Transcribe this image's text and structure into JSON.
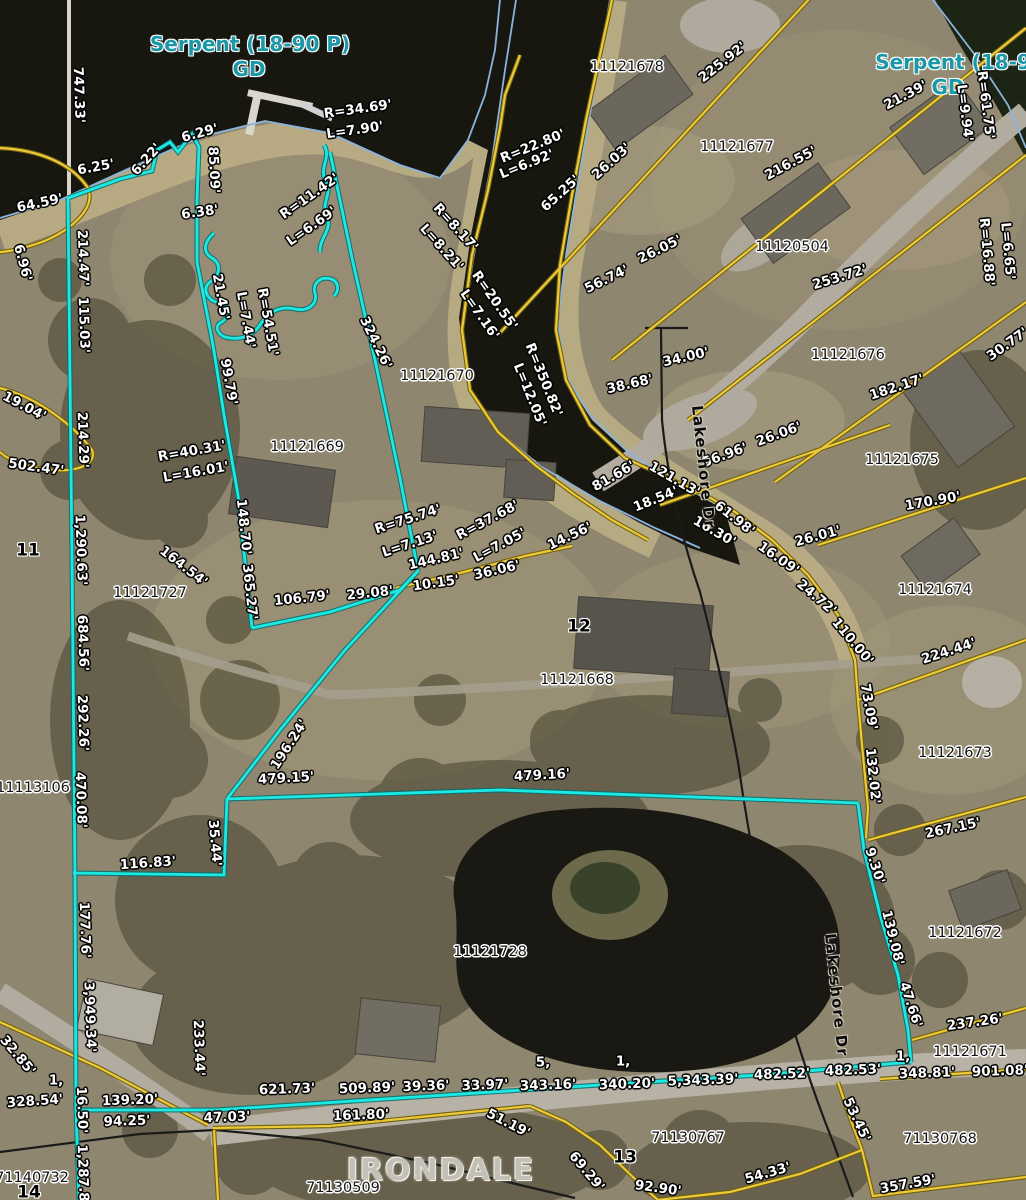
{
  "map": {
    "place_name": "IRONDALE",
    "street_name": "Lakeshore Dr",
    "water_feature": "Serpent (18-90 P) GD"
  },
  "colors": {
    "highlight_boundary": "#1de9e3",
    "parcel_line": "#eec939",
    "shoreline": "#8ab4dd",
    "survey_line": "#1a1a1a",
    "dimension_text": "#ffffff",
    "parcel_id_text": "#141414",
    "water_label_text": "#1b98a8"
  },
  "labels": [
    {
      "t": "Serpent (18-90 P)",
      "x": 250,
      "y": 44,
      "r": 0,
      "c": "water"
    },
    {
      "t": "GD",
      "x": 249,
      "y": 69,
      "r": 0,
      "c": "water"
    },
    {
      "t": "Serpent (18-90",
      "x": 960,
      "y": 62,
      "r": 0,
      "c": "water"
    },
    {
      "t": "GD",
      "x": 948,
      "y": 87,
      "r": 0,
      "c": "water"
    },
    {
      "t": "747.33'",
      "x": 78,
      "y": 95,
      "r": 88,
      "c": "dim"
    },
    {
      "t": "6.29'",
      "x": 200,
      "y": 134,
      "r": -15,
      "c": "dim"
    },
    {
      "t": "6.25'",
      "x": 96,
      "y": 168,
      "r": -10,
      "c": "dim"
    },
    {
      "t": "6.22'",
      "x": 147,
      "y": 160,
      "r": -48,
      "c": "dim"
    },
    {
      "t": "64.59'",
      "x": 40,
      "y": 204,
      "r": -12,
      "c": "dim"
    },
    {
      "t": "85.09'",
      "x": 213,
      "y": 170,
      "r": 87,
      "c": "dim"
    },
    {
      "t": "6.38'",
      "x": 200,
      "y": 213,
      "r": -8,
      "c": "dim"
    },
    {
      "t": "6.96'",
      "x": 22,
      "y": 263,
      "r": 75,
      "c": "dim"
    },
    {
      "t": "R=11.42'",
      "x": 310,
      "y": 197,
      "r": -35,
      "c": "dim"
    },
    {
      "t": "L=6.69'",
      "x": 312,
      "y": 227,
      "r": -35,
      "c": "dim"
    },
    {
      "t": "R=34.69'",
      "x": 358,
      "y": 110,
      "r": -8,
      "c": "dim"
    },
    {
      "t": "L=7.90'",
      "x": 355,
      "y": 131,
      "r": -8,
      "c": "dim"
    },
    {
      "t": "R=22.80'",
      "x": 533,
      "y": 147,
      "r": -22,
      "c": "dim"
    },
    {
      "t": "L=6.92'",
      "x": 527,
      "y": 165,
      "r": -22,
      "c": "dim"
    },
    {
      "t": "225.92'",
      "x": 723,
      "y": 63,
      "r": -38,
      "c": "dim"
    },
    {
      "t": "21.39'",
      "x": 906,
      "y": 96,
      "r": -28,
      "c": "dim"
    },
    {
      "t": "65.25'",
      "x": 561,
      "y": 194,
      "r": -42,
      "c": "dim"
    },
    {
      "t": "26.03'",
      "x": 612,
      "y": 162,
      "r": -42,
      "c": "dim"
    },
    {
      "t": "216.55'",
      "x": 791,
      "y": 164,
      "r": -28,
      "c": "dim"
    },
    {
      "t": "R=61.75'",
      "x": 985,
      "y": 105,
      "r": 83,
      "c": "dim"
    },
    {
      "t": "L=9.94'",
      "x": 964,
      "y": 113,
      "r": 83,
      "c": "dim"
    },
    {
      "t": "R=8.17'",
      "x": 455,
      "y": 228,
      "r": 48,
      "c": "dim"
    },
    {
      "t": "L=8.21'",
      "x": 441,
      "y": 248,
      "r": 48,
      "c": "dim"
    },
    {
      "t": "R=16.88'",
      "x": 986,
      "y": 252,
      "r": 85,
      "c": "dim"
    },
    {
      "t": "L=6.65'",
      "x": 1007,
      "y": 251,
      "r": 85,
      "c": "dim"
    },
    {
      "t": "214.47'",
      "x": 82,
      "y": 258,
      "r": 88,
      "c": "dim"
    },
    {
      "t": "115.03'",
      "x": 83,
      "y": 325,
      "r": 88,
      "c": "dim"
    },
    {
      "t": "21.45'",
      "x": 220,
      "y": 297,
      "r": 80,
      "c": "dim"
    },
    {
      "t": "L=7.44'",
      "x": 245,
      "y": 320,
      "r": 80,
      "c": "dim"
    },
    {
      "t": "R=54.51'",
      "x": 267,
      "y": 322,
      "r": 80,
      "c": "dim"
    },
    {
      "t": "99.79'",
      "x": 228,
      "y": 382,
      "r": 80,
      "c": "dim"
    },
    {
      "t": "324.26'",
      "x": 375,
      "y": 343,
      "r": 64,
      "c": "dim"
    },
    {
      "t": "R=20.55'",
      "x": 494,
      "y": 301,
      "r": 55,
      "c": "dim"
    },
    {
      "t": "L=7.16'",
      "x": 479,
      "y": 315,
      "r": 55,
      "c": "dim"
    },
    {
      "t": "R=350.82'",
      "x": 543,
      "y": 380,
      "r": 68,
      "c": "dim"
    },
    {
      "t": "L=12.05'",
      "x": 529,
      "y": 395,
      "r": 68,
      "c": "dim"
    },
    {
      "t": "19.04'",
      "x": 24,
      "y": 407,
      "r": 28,
      "c": "dim"
    },
    {
      "t": "214.29'",
      "x": 82,
      "y": 440,
      "r": 88,
      "c": "dim"
    },
    {
      "t": "502.47'",
      "x": 36,
      "y": 468,
      "r": 8,
      "c": "dim"
    },
    {
      "t": "253.72'",
      "x": 840,
      "y": 278,
      "r": -17,
      "c": "dim"
    },
    {
      "t": "38.68'",
      "x": 630,
      "y": 385,
      "r": -13,
      "c": "dim"
    },
    {
      "t": "34.00'",
      "x": 686,
      "y": 358,
      "r": -13,
      "c": "dim"
    },
    {
      "t": "56.74'",
      "x": 607,
      "y": 280,
      "r": -26,
      "c": "dim"
    },
    {
      "t": "26.05'",
      "x": 660,
      "y": 250,
      "r": -26,
      "c": "dim"
    },
    {
      "t": "182.17'",
      "x": 897,
      "y": 388,
      "r": -18,
      "c": "dim"
    },
    {
      "t": "30.77'",
      "x": 1008,
      "y": 345,
      "r": -35,
      "c": "dim"
    },
    {
      "t": "R=40.31'",
      "x": 192,
      "y": 452,
      "r": -10,
      "c": "dim"
    },
    {
      "t": "L=16.01'",
      "x": 196,
      "y": 473,
      "r": -10,
      "c": "dim"
    },
    {
      "t": "56.96'",
      "x": 725,
      "y": 456,
      "r": -20,
      "c": "dim"
    },
    {
      "t": "26.06'",
      "x": 779,
      "y": 435,
      "r": -20,
      "c": "dim"
    },
    {
      "t": "170.90'",
      "x": 933,
      "y": 502,
      "r": -10,
      "c": "dim"
    },
    {
      "t": "26.01'",
      "x": 818,
      "y": 537,
      "r": -15,
      "c": "dim"
    },
    {
      "t": "81.66'",
      "x": 614,
      "y": 477,
      "r": -30,
      "c": "dim"
    },
    {
      "t": "121.13'",
      "x": 674,
      "y": 480,
      "r": 30,
      "c": "dim"
    },
    {
      "t": "18.54'",
      "x": 656,
      "y": 500,
      "r": -22,
      "c": "dim"
    },
    {
      "t": "14.56'",
      "x": 570,
      "y": 537,
      "r": -25,
      "c": "dim"
    },
    {
      "t": "16.30'",
      "x": 714,
      "y": 532,
      "r": 30,
      "c": "dim"
    },
    {
      "t": "61.98'",
      "x": 734,
      "y": 519,
      "r": 38,
      "c": "dim"
    },
    {
      "t": "16.09'",
      "x": 778,
      "y": 559,
      "r": 35,
      "c": "dim"
    },
    {
      "t": "24.72'",
      "x": 816,
      "y": 598,
      "r": 40,
      "c": "dim"
    },
    {
      "t": "110.00'",
      "x": 852,
      "y": 642,
      "r": 50,
      "c": "dim"
    },
    {
      "t": "R=75.74'",
      "x": 408,
      "y": 520,
      "r": -18,
      "c": "dim"
    },
    {
      "t": "L=7.13'",
      "x": 410,
      "y": 545,
      "r": -18,
      "c": "dim"
    },
    {
      "t": "R=37.68'",
      "x": 488,
      "y": 521,
      "r": -28,
      "c": "dim"
    },
    {
      "t": "L=7.05'",
      "x": 500,
      "y": 546,
      "r": -28,
      "c": "dim"
    },
    {
      "t": "144.81'",
      "x": 436,
      "y": 560,
      "r": -13,
      "c": "dim"
    },
    {
      "t": "10.15'",
      "x": 436,
      "y": 584,
      "r": -8,
      "c": "dim"
    },
    {
      "t": "36.06'",
      "x": 497,
      "y": 571,
      "r": -13,
      "c": "dim"
    },
    {
      "t": "148.70'",
      "x": 243,
      "y": 527,
      "r": 84,
      "c": "dim"
    },
    {
      "t": "365.27'",
      "x": 249,
      "y": 592,
      "r": 84,
      "c": "dim"
    },
    {
      "t": "164.54'",
      "x": 183,
      "y": 567,
      "r": 38,
      "c": "dim"
    },
    {
      "t": "106.79'",
      "x": 302,
      "y": 599,
      "r": -6,
      "c": "dim"
    },
    {
      "t": "29.08'",
      "x": 370,
      "y": 594,
      "r": -6,
      "c": "dim"
    },
    {
      "t": "224.44'",
      "x": 949,
      "y": 652,
      "r": -18,
      "c": "dim"
    },
    {
      "t": "73.09'",
      "x": 868,
      "y": 707,
      "r": 80,
      "c": "dim"
    },
    {
      "t": "132.02'",
      "x": 872,
      "y": 776,
      "r": 84,
      "c": "dim"
    },
    {
      "t": "267.15'",
      "x": 953,
      "y": 829,
      "r": -12,
      "c": "dim"
    },
    {
      "t": "1,290.63'",
      "x": 80,
      "y": 550,
      "r": 88,
      "c": "dim"
    },
    {
      "t": "684.56'",
      "x": 82,
      "y": 643,
      "r": 88,
      "c": "dim"
    },
    {
      "t": "292.26'",
      "x": 82,
      "y": 723,
      "r": 88,
      "c": "dim"
    },
    {
      "t": "470.08'",
      "x": 80,
      "y": 800,
      "r": 88,
      "c": "dim"
    },
    {
      "t": "196.24'",
      "x": 290,
      "y": 745,
      "r": -57,
      "c": "dim"
    },
    {
      "t": "479.15'",
      "x": 286,
      "y": 779,
      "r": -3,
      "c": "dim"
    },
    {
      "t": "479.16'",
      "x": 542,
      "y": 776,
      "r": -3,
      "c": "dim"
    },
    {
      "t": "116.83'",
      "x": 148,
      "y": 864,
      "r": -4,
      "c": "dim"
    },
    {
      "t": "35.44'",
      "x": 214,
      "y": 843,
      "r": 85,
      "c": "dim"
    },
    {
      "t": "177.76'",
      "x": 84,
      "y": 930,
      "r": 88,
      "c": "dim"
    },
    {
      "t": "3,949.34'",
      "x": 89,
      "y": 1017,
      "r": 88,
      "c": "dim"
    },
    {
      "t": "9.30'",
      "x": 874,
      "y": 866,
      "r": 72,
      "c": "dim"
    },
    {
      "t": "139.08'",
      "x": 892,
      "y": 938,
      "r": 76,
      "c": "dim"
    },
    {
      "t": "47.66'",
      "x": 910,
      "y": 1005,
      "r": 72,
      "c": "dim"
    },
    {
      "t": "237.26'",
      "x": 975,
      "y": 1023,
      "r": -8,
      "c": "dim"
    },
    {
      "t": "32.85'",
      "x": 17,
      "y": 1056,
      "r": 50,
      "c": "dim"
    },
    {
      "t": "233.44'",
      "x": 198,
      "y": 1048,
      "r": 88,
      "c": "dim"
    },
    {
      "t": "1,",
      "x": 56,
      "y": 1081,
      "r": 0,
      "c": "dim"
    },
    {
      "t": "328.54'",
      "x": 35,
      "y": 1102,
      "r": -4,
      "c": "dim"
    },
    {
      "t": "16.50'",
      "x": 81,
      "y": 1110,
      "r": 88,
      "c": "dim"
    },
    {
      "t": "1,287.8",
      "x": 82,
      "y": 1173,
      "r": 88,
      "c": "dim"
    },
    {
      "t": "139.20'",
      "x": 130,
      "y": 1101,
      "r": -2,
      "c": "dim"
    },
    {
      "t": "94.25'",
      "x": 127,
      "y": 1122,
      "r": -2,
      "c": "dim"
    },
    {
      "t": "47.03'",
      "x": 227,
      "y": 1118,
      "r": -2,
      "c": "dim"
    },
    {
      "t": "621.73'",
      "x": 287,
      "y": 1090,
      "r": -2,
      "c": "dim"
    },
    {
      "t": "509.89'",
      "x": 367,
      "y": 1089,
      "r": -2,
      "c": "dim"
    },
    {
      "t": "39.36'",
      "x": 426,
      "y": 1087,
      "r": -2,
      "c": "dim"
    },
    {
      "t": "33.97'",
      "x": 485,
      "y": 1086,
      "r": -2,
      "c": "dim"
    },
    {
      "t": "343.16'",
      "x": 548,
      "y": 1086,
      "r": -2,
      "c": "dim"
    },
    {
      "t": "340.20'",
      "x": 627,
      "y": 1085,
      "r": -2,
      "c": "dim"
    },
    {
      "t": "5,",
      "x": 543,
      "y": 1063,
      "r": 0,
      "c": "dim"
    },
    {
      "t": "1,",
      "x": 623,
      "y": 1062,
      "r": 0,
      "c": "dim"
    },
    {
      "t": "5,343.39'",
      "x": 703,
      "y": 1081,
      "r": -2,
      "c": "dim"
    },
    {
      "t": "482.52'",
      "x": 782,
      "y": 1075,
      "r": -2,
      "c": "dim"
    },
    {
      "t": "482.53'",
      "x": 853,
      "y": 1071,
      "r": -2,
      "c": "dim"
    },
    {
      "t": "1,",
      "x": 903,
      "y": 1057,
      "r": 0,
      "c": "dim"
    },
    {
      "t": "348.81'",
      "x": 927,
      "y": 1074,
      "r": -2,
      "c": "dim"
    },
    {
      "t": "901.08'",
      "x": 1000,
      "y": 1072,
      "r": -2,
      "c": "dim"
    },
    {
      "t": "161.80'",
      "x": 361,
      "y": 1116,
      "r": -2,
      "c": "dim"
    },
    {
      "t": "51.19'",
      "x": 508,
      "y": 1124,
      "r": 27,
      "c": "dim"
    },
    {
      "t": "69.29'",
      "x": 586,
      "y": 1172,
      "r": 50,
      "c": "dim"
    },
    {
      "t": "92.90'",
      "x": 658,
      "y": 1189,
      "r": 8,
      "c": "dim"
    },
    {
      "t": "53.45'",
      "x": 856,
      "y": 1120,
      "r": 65,
      "c": "dim"
    },
    {
      "t": "54.33'",
      "x": 768,
      "y": 1174,
      "r": -16,
      "c": "dim"
    },
    {
      "t": "357.59'",
      "x": 908,
      "y": 1185,
      "r": -10,
      "c": "dim"
    },
    {
      "t": "11",
      "x": 28,
      "y": 551,
      "r": 0,
      "c": "lot"
    },
    {
      "t": "12",
      "x": 579,
      "y": 627,
      "r": 0,
      "c": "lot"
    },
    {
      "t": "13",
      "x": 625,
      "y": 1158,
      "r": 0,
      "c": "lot"
    },
    {
      "t": "14",
      "x": 29,
      "y": 1193,
      "r": 0,
      "c": "lot"
    },
    {
      "t": "11121678",
      "x": 627,
      "y": 67,
      "r": 0,
      "c": "pid"
    },
    {
      "t": "11121677",
      "x": 737,
      "y": 147,
      "r": 0,
      "c": "pid"
    },
    {
      "t": "11120504",
      "x": 792,
      "y": 247,
      "r": 0,
      "c": "pid"
    },
    {
      "t": "11121676",
      "x": 848,
      "y": 355,
      "r": 0,
      "c": "pid"
    },
    {
      "t": "11121670",
      "x": 437,
      "y": 376,
      "r": 0,
      "c": "pid"
    },
    {
      "t": "11121669",
      "x": 307,
      "y": 447,
      "r": 0,
      "c": "pid"
    },
    {
      "t": "11121675",
      "x": 902,
      "y": 460,
      "r": 0,
      "c": "pid"
    },
    {
      "t": "11121674",
      "x": 935,
      "y": 590,
      "r": 0,
      "c": "pid"
    },
    {
      "t": "11121727",
      "x": 150,
      "y": 593,
      "r": 0,
      "c": "pid"
    },
    {
      "t": "11121668",
      "x": 577,
      "y": 680,
      "r": 0,
      "c": "pid"
    },
    {
      "t": "11121673",
      "x": 955,
      "y": 753,
      "r": 0,
      "c": "pid"
    },
    {
      "t": "11113106",
      "x": 33,
      "y": 788,
      "r": 0,
      "c": "pid"
    },
    {
      "t": "11121672",
      "x": 965,
      "y": 933,
      "r": 0,
      "c": "pid"
    },
    {
      "t": "11121728",
      "x": 490,
      "y": 952,
      "r": 0,
      "c": "pid"
    },
    {
      "t": "11121671",
      "x": 970,
      "y": 1052,
      "r": 0,
      "c": "pid"
    },
    {
      "t": "71140732",
      "x": 32,
      "y": 1178,
      "r": 0,
      "c": "pid"
    },
    {
      "t": "71130509",
      "x": 343,
      "y": 1188,
      "r": 0,
      "c": "pid"
    },
    {
      "t": "71130767",
      "x": 688,
      "y": 1138,
      "r": 0,
      "c": "pid"
    },
    {
      "t": "71130768",
      "x": 940,
      "y": 1139,
      "r": 0,
      "c": "pid"
    },
    {
      "t": "Lakeshore Dr",
      "x": 703,
      "y": 467,
      "r": 84,
      "c": "road"
    },
    {
      "t": "Lakeshore Dr",
      "x": 836,
      "y": 995,
      "r": 84,
      "c": "road"
    },
    {
      "t": "IRONDALE",
      "x": 441,
      "y": 1171,
      "r": 0,
      "c": "place"
    }
  ]
}
